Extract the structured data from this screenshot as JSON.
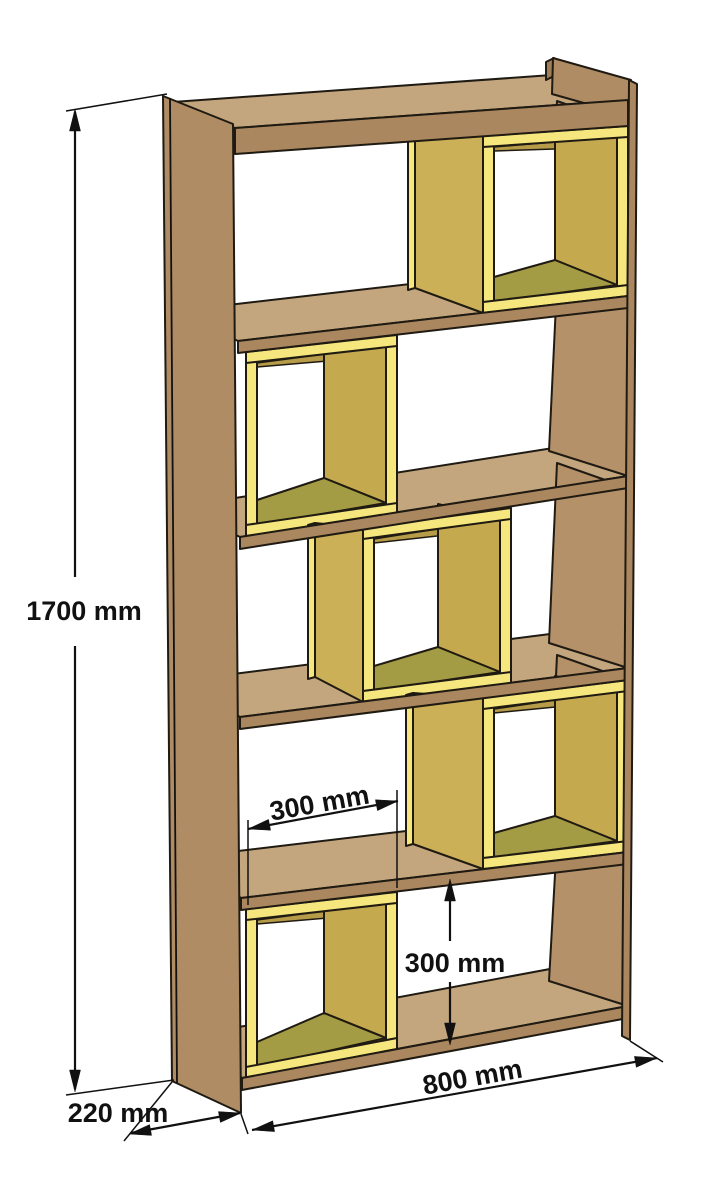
{
  "diagram": {
    "subject": "bookshelf-assembly-dimension-drawing",
    "shelf_count": 6,
    "box_count": 5,
    "dimensions": {
      "height_label": "1700 mm",
      "depth_label": "220 mm",
      "width_label": "800 mm",
      "box_width_label": "300 mm",
      "compartment_height_label": "300 mm"
    },
    "colors": {
      "wood_face": "#b08c64",
      "wood_top": "#c3a67e",
      "wood_edge": "#ab875f",
      "wood_inner": "#b5916a",
      "wood_dark": "#9f7e58",
      "box_edge_bright": "#f5e77d",
      "box_side": "#cbb057",
      "box_side_inner": "#c5a94e",
      "box_ceiling": "#b69c48",
      "box_floor": "#a49b45",
      "outline": "#1f1a12",
      "dimension": "#111111",
      "background": "#ffffff"
    }
  }
}
